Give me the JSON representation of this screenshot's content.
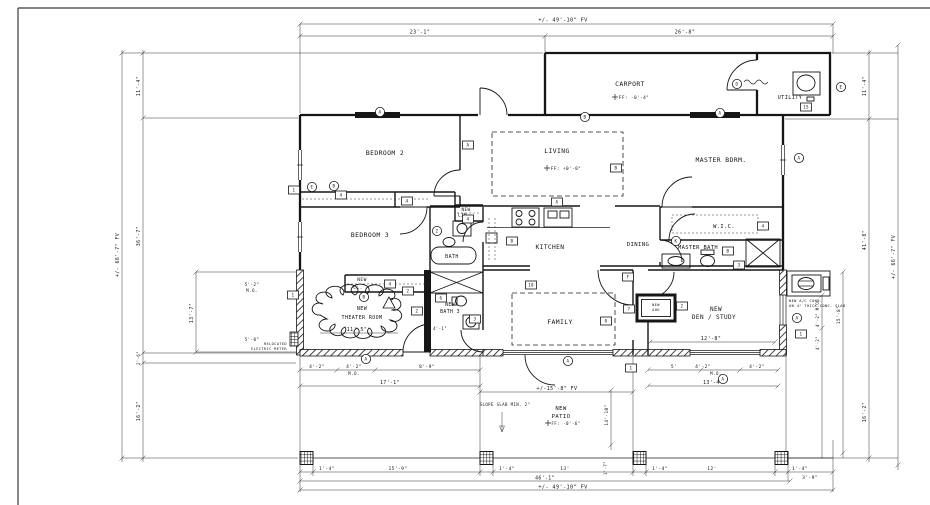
{
  "rooms": {
    "carport": "CARPORT",
    "utility": "UTILITY",
    "bedroom2": "BEDROOM 2",
    "living": "LIVING",
    "master_bdrm": "MASTER BDRM.",
    "bedroom3": "BEDROOM 3",
    "wic": "W.I.C.",
    "kitchen": "KITCHEN",
    "dining": "DINING",
    "master_bath": "MASTER BATH",
    "bath": "BATH",
    "new_lin_1": "NEW",
    "new_lin_2": "LIN.",
    "new_cl_1": "NEW",
    "new_cl_2": "CL.",
    "theater_1": "NEW",
    "theater_2": "THEATER ROOM",
    "bath3_1": "NEW",
    "bath3_2": "BATH 3",
    "family": "FAMILY",
    "den_1": "NEW",
    "den_2": "DEN / STUDY",
    "patio_1": "NEW",
    "patio_2": "PATIO",
    "ahu_1": "NEW",
    "ahu_2": "AHU"
  },
  "dims": {
    "top_overall": "+/- 49'-10\" FV",
    "top_left": "23'-1\"",
    "top_right": "26'-8\"",
    "left_outer": "+/- 66'-7\" FV",
    "left_11_4": "11'-4\"",
    "left_mid": "36'-7\"",
    "left_2_6": "2'-6\"",
    "left_16_2": "16'-2\"",
    "right_outer": "+/- 66'-7\" FV",
    "right_11_4": "11'-4\"",
    "right_mid": "41'-8\"",
    "right_16_2": "16'-2\"",
    "theater_13_7": "13'-7\"",
    "theater_width": "11'-5\"",
    "theater_5_2": "5'-2\"",
    "theater_mo": "M.O.",
    "theater_5_0": "5'-0\"",
    "bath3_4_1": "4'-1\"",
    "den_width": "12'-8\"",
    "chain_l_a": "4'-2\"",
    "chain_l_b": "4'-2\"",
    "chain_l_mo": "M.O.",
    "chain_l_c": "8'-9\"",
    "chain_l_total": "17'-1\"",
    "chain_r_a": "5'",
    "chain_r_b": "4'-2\"",
    "chain_r_mo": "M.O.",
    "chain_r_c": "4'-2\"",
    "chain_r_total": "13'-4\"",
    "patio_width": "+/-15'-8\" FV",
    "patio_depth": "14'-10\"",
    "bot_p1": "1'-4\"",
    "bot_15_9": "15'-9\"",
    "bot_p2": "1'-4\"",
    "bot_13": "13'",
    "bot_p3": "1'-4\"",
    "bot_12": "12'",
    "bot_p4": "1'-4\"",
    "bot_3_9": "3'-9\"",
    "bot_1_7": "1'-7\"",
    "bot_46_1": "46'-1\"",
    "bot_overall": "+/- 49'-10\" FV",
    "ac_4_2_mo": "4'-2\" M.O.",
    "ac_15_8": "15'-8\"",
    "ac_4_2": "4'-2\""
  },
  "annotations": {
    "carport_ff": "FF: -0'-4\"",
    "living_ff": "FF: +0'-0\"",
    "patio_ff": "FF: -0'-6\"",
    "slope": "SLOPE SLAB MIN. 2\"",
    "ac_1": "NEW A/C COND.",
    "ac_2": "ON 4\" THICK CONC. SLAB",
    "meter_1": "RELOCATED",
    "meter_2": "ELECTRIC METER"
  },
  "tags": [
    {
      "shape": "c",
      "x": 312,
      "y": 187,
      "label": "E"
    },
    {
      "shape": "c",
      "x": 334,
      "y": 186,
      "label": "B"
    },
    {
      "shape": "c",
      "x": 380,
      "y": 112,
      "label": "A"
    },
    {
      "shape": "c",
      "x": 585,
      "y": 117,
      "label": "B"
    },
    {
      "shape": "c",
      "x": 720,
      "y": 113,
      "label": "A"
    },
    {
      "shape": "c",
      "x": 737,
      "y": 84,
      "label": "D"
    },
    {
      "shape": "c",
      "x": 841,
      "y": 87,
      "label": "E"
    },
    {
      "shape": "c",
      "x": 799,
      "y": 158,
      "label": "A"
    },
    {
      "shape": "c",
      "x": 676,
      "y": 241,
      "label": "K"
    },
    {
      "shape": "c",
      "x": 364,
      "y": 297,
      "label": "B"
    },
    {
      "shape": "c",
      "x": 366,
      "y": 359,
      "label": "A"
    },
    {
      "shape": "c",
      "x": 568,
      "y": 361,
      "label": "A"
    },
    {
      "shape": "c",
      "x": 723,
      "y": 379,
      "label": "A"
    },
    {
      "shape": "c",
      "x": 797,
      "y": 318,
      "label": "A"
    },
    {
      "shape": "c",
      "x": 437,
      "y": 231,
      "label": "2"
    },
    {
      "shape": "b",
      "x": 468,
      "y": 145,
      "label": "A"
    },
    {
      "shape": "b",
      "x": 557,
      "y": 202,
      "label": "A"
    },
    {
      "shape": "b",
      "x": 616,
      "y": 168,
      "label": "B"
    },
    {
      "shape": "b",
      "x": 341,
      "y": 195,
      "label": "4"
    },
    {
      "shape": "b",
      "x": 407,
      "y": 201,
      "label": "4"
    },
    {
      "shape": "b",
      "x": 294,
      "y": 190,
      "label": "1"
    },
    {
      "shape": "b",
      "x": 293,
      "y": 295,
      "label": "1"
    },
    {
      "shape": "b",
      "x": 408,
      "y": 291,
      "label": "2"
    },
    {
      "shape": "b",
      "x": 417,
      "y": 311,
      "label": "2"
    },
    {
      "shape": "b",
      "x": 390,
      "y": 284,
      "label": "4"
    },
    {
      "shape": "b",
      "x": 468,
      "y": 219,
      "label": "4"
    },
    {
      "shape": "b",
      "x": 441,
      "y": 298,
      "label": "6"
    },
    {
      "shape": "b",
      "x": 475,
      "y": 319,
      "label": "3"
    },
    {
      "shape": "b",
      "x": 606,
      "y": 321,
      "label": "8"
    },
    {
      "shape": "b",
      "x": 531,
      "y": 285,
      "label": "10"
    },
    {
      "shape": "b",
      "x": 628,
      "y": 277,
      "label": "F"
    },
    {
      "shape": "b",
      "x": 629,
      "y": 309,
      "label": "7"
    },
    {
      "shape": "b",
      "x": 682,
      "y": 306,
      "label": "2"
    },
    {
      "shape": "b",
      "x": 763,
      "y": 226,
      "label": "4"
    },
    {
      "shape": "b",
      "x": 728,
      "y": 251,
      "label": "B"
    },
    {
      "shape": "b",
      "x": 739,
      "y": 265,
      "label": "3"
    },
    {
      "shape": "b",
      "x": 631,
      "y": 368,
      "label": "1"
    },
    {
      "shape": "b",
      "x": 801,
      "y": 334,
      "label": "1"
    },
    {
      "shape": "b",
      "x": 806,
      "y": 107,
      "label": "15"
    },
    {
      "shape": "b",
      "x": 512,
      "y": 241,
      "label": "B"
    },
    {
      "shape": "t",
      "x": 389,
      "y": 303,
      "label": ""
    }
  ],
  "posts": [
    306.5,
    486.5,
    639.5,
    781.5
  ]
}
